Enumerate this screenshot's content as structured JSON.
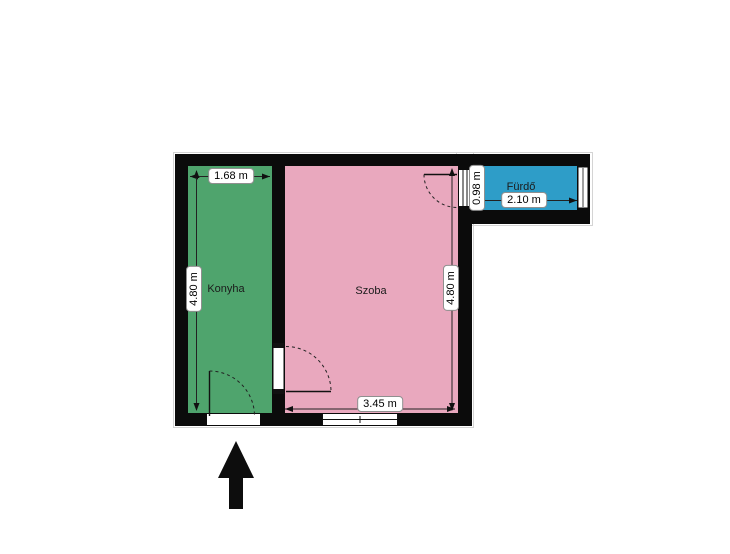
{
  "plan": {
    "rooms": [
      {
        "name": "Konyha",
        "color": "#4FA46D",
        "width_label": "1.68 m",
        "height_label": "4.80 m"
      },
      {
        "name": "Szoba",
        "color": "#E9A8BE",
        "width_label": "3.45 m",
        "height_label": "4.80 m"
      },
      {
        "name": "Fürdő",
        "color": "#2E9DC8",
        "width_label": "2.10 m",
        "height_label": "0.98 m"
      }
    ],
    "colors": {
      "wall": "#0b0b0b",
      "background": "#ffffff",
      "outline": "#d4d4d4"
    },
    "icons": {
      "entrance": "up-arrow"
    }
  }
}
